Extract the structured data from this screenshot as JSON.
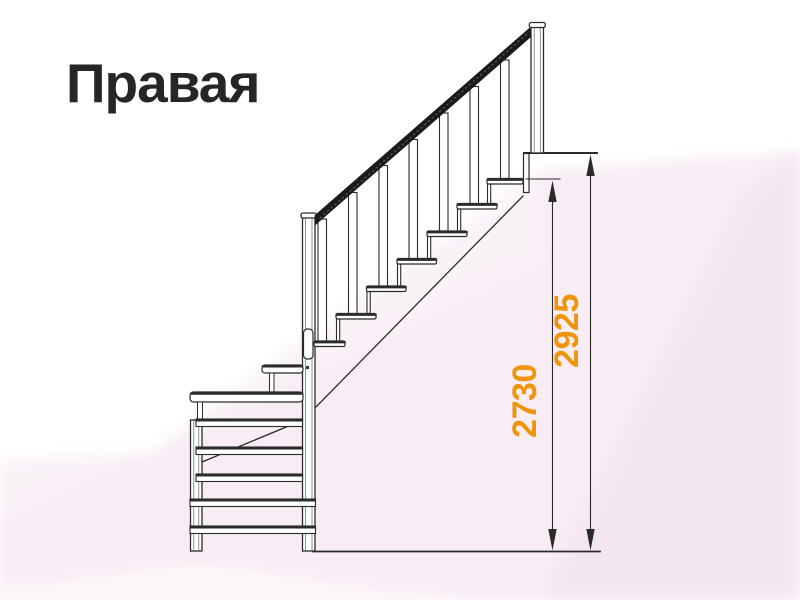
{
  "title": "Правая",
  "diagram": {
    "type": "staircase-side-view-drawing",
    "dimensions": [
      {
        "id": "height-to-top-tread",
        "value": "2730",
        "unit": "mm",
        "color": "#ef940b"
      },
      {
        "id": "height-to-landing",
        "value": "2925",
        "unit": "mm",
        "color": "#ef940b"
      }
    ],
    "stair": {
      "upper_flight_treads": 7,
      "lower_railing_horizontal_rails": 5
    },
    "colors": {
      "line": "#2b2b2b",
      "accent_orange": "#ef940b",
      "background_pink": "#f8edf5",
      "title_text": "#262626"
    }
  }
}
